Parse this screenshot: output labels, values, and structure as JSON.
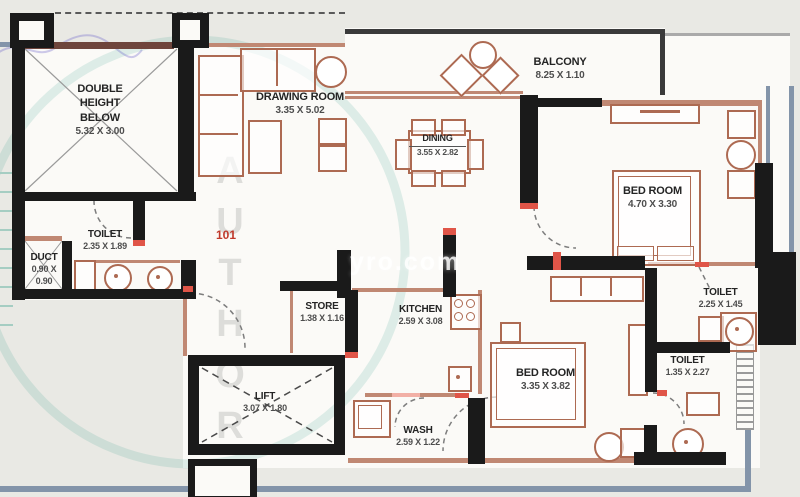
{
  "unit_number": "101",
  "watermark": {
    "site_text": "yro.com",
    "stamp_text": "AUTHORI"
  },
  "rooms": {
    "double_height": {
      "name": "DOUBLE HEIGHT BELOW",
      "dims": "5.32 X 3.00"
    },
    "duct": {
      "name": "DUCT",
      "dims_line1": "0.90 X",
      "dims_line2": "0.90"
    },
    "toilet_entry": {
      "name": "TOILET",
      "dims": "2.35 X 1.89"
    },
    "drawing_room": {
      "name": "DRAWING ROOM",
      "dims": "3.35 X 5.02"
    },
    "balcony": {
      "name": "BALCONY",
      "dims": "8.25 X 1.10"
    },
    "dining": {
      "name": "DINING",
      "dims": "3.55 X 2.82"
    },
    "bedroom_master": {
      "name": "BED ROOM",
      "dims": "4.70 X 3.30"
    },
    "toilet_master": {
      "name": "TOILET",
      "dims": "2.25 X 1.45"
    },
    "toilet_common": {
      "name": "TOILET",
      "dims": "1.35 X 2.27"
    },
    "store": {
      "name": "STORE",
      "dims": "1.38 X 1.16"
    },
    "kitchen": {
      "name": "KITCHEN",
      "dims": "2.59 X 3.08"
    },
    "bedroom_second": {
      "name": "BED ROOM",
      "dims": "3.35 X 3.82"
    },
    "lift": {
      "name": "LIFT",
      "dims": "3.07 X 1.80"
    },
    "wash": {
      "name": "WASH",
      "dims": "2.59 X 1.22"
    }
  },
  "colors": {
    "wall": "#1a1a1a",
    "furniture": "#ad6a52",
    "accent_red": "#e05548",
    "unit_number_red": "#c0392b",
    "boundary_blue": "#8394a9",
    "stamp_teal": "#17967e"
  }
}
